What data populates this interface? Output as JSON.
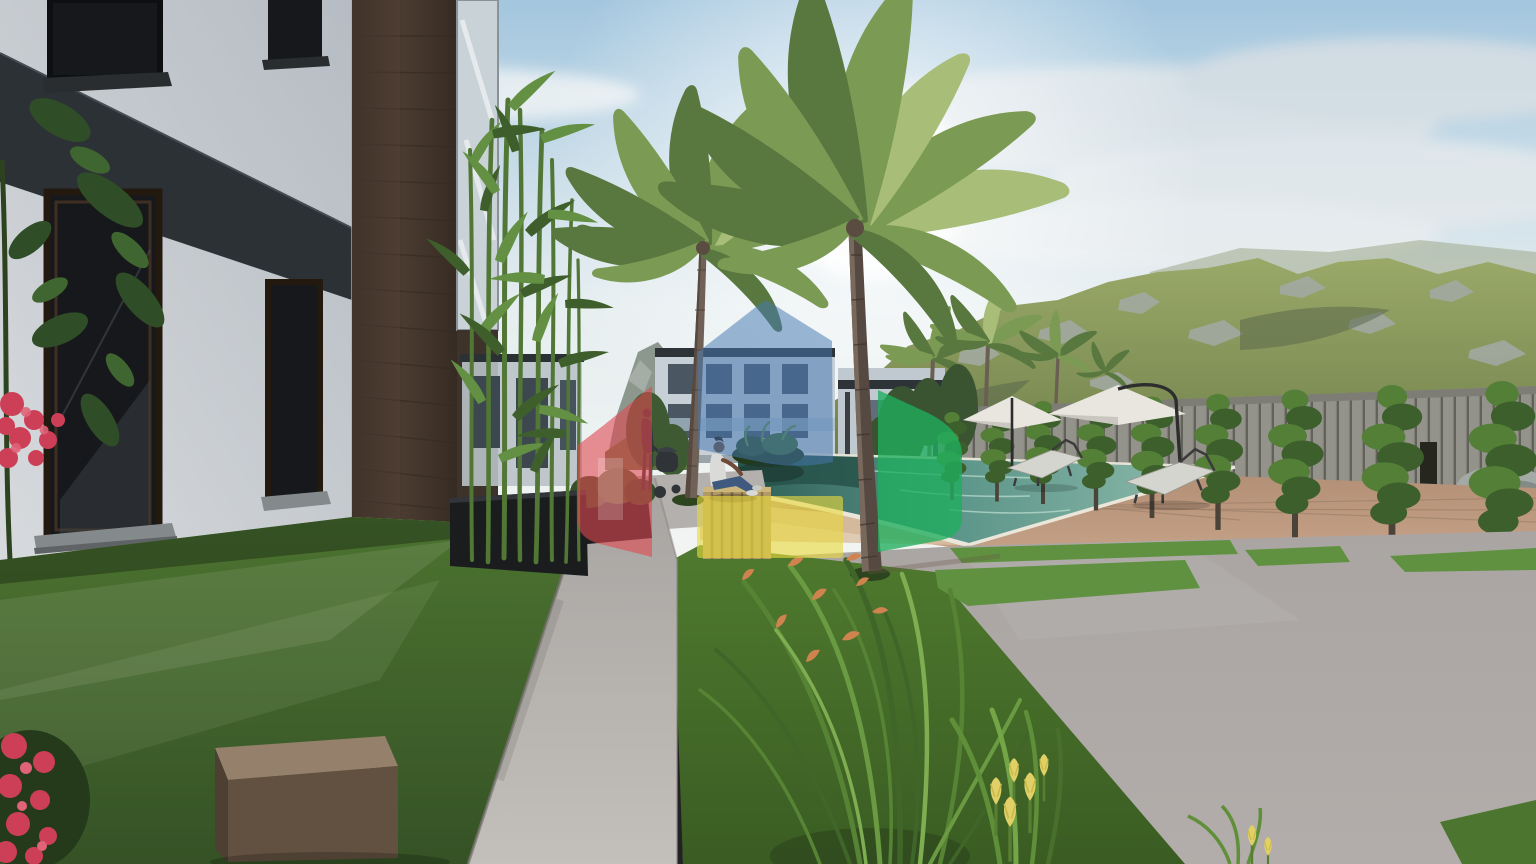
{
  "scene": {
    "description": "3D architectural rendering of a modern residential complex: white and dark-wood apartment building at left, concrete garden path, two tall palm trees, swimming pool with sun loungers and white umbrellas on a wooden deck, spiral topiary trees along a stone slat fence, green rocky mountains behind, sunlit hazy sky; a person sits at the pool edge and a semi-transparent red, blue, green and yellow house-shaped logo watermark overlays the center."
  },
  "watermark": {
    "shapes": [
      {
        "name": "red-house",
        "color": "#e04a52",
        "opacity": 0.6
      },
      {
        "name": "blue-house",
        "color": "#4579b2",
        "opacity": 0.52
      },
      {
        "name": "green-house",
        "color": "#1fae5e",
        "opacity": 0.78
      },
      {
        "name": "yellow-block",
        "color": "#e9d83e",
        "opacity": 0.62
      }
    ]
  },
  "palette": {
    "skyTop": "#a3c6de",
    "skyLow": "#e6eef0",
    "sunWhite": "#ffffff",
    "cloud": "#e9eef1",
    "mtGreen": "#7e8e55",
    "mtLight": "#9aa968",
    "mtShadow": "#5a6a43",
    "rock": "#a3aaa5",
    "farRidge": "#9da88a",
    "leftPeak": "#8c978d",
    "facade": "#d7dadd",
    "facadeShade": "#b6bcc3",
    "band": "#2c3136",
    "windowGlass": "#16181b",
    "sill": "#84898b",
    "wood": "#4a3b30",
    "woodDark": "#362b23",
    "glassStrip": "#c8d2d7",
    "distFacade": "#c7d0d6",
    "distWindow": "#4a5763",
    "distBeam": "#2e3338",
    "distGlass": "#a9bcc8",
    "bambooStalk": "#517636",
    "palmTrunk": "#6f6156",
    "palmTrunkDark": "#554941",
    "poolDeep": "#2e6057",
    "poolLight": "#93bfae",
    "coping": "#eae6da",
    "deck": "#c3a086",
    "deckLight": "#dbc0a4",
    "fenceSlat": "#93938b",
    "fenceGap": "#62625b",
    "umbrella": "#e8e6df",
    "pole": "#2d2d2d",
    "cushion": "#d5d5cf",
    "loungerFrame": "#3b3b3b",
    "grass": "#47682c",
    "grassLight": "#5d8838",
    "grassDark": "#2f4a1e",
    "grassBright": "#5f9140",
    "path": "#bab6b3",
    "patio": "#b2adaa",
    "blockTop": "#95806c",
    "blockFront": "#625040",
    "planter": "#1b1c1e",
    "crate": "#b19a66",
    "crateDark": "#8a7448",
    "flowerRed": "#cd3f57",
    "crocosmia": "#cf8450",
    "tulip": "#e0d065",
    "skin": "#6e4a37",
    "shirt": "#dadad8",
    "jeans": "#40597e",
    "silhouette": "#303439"
  }
}
